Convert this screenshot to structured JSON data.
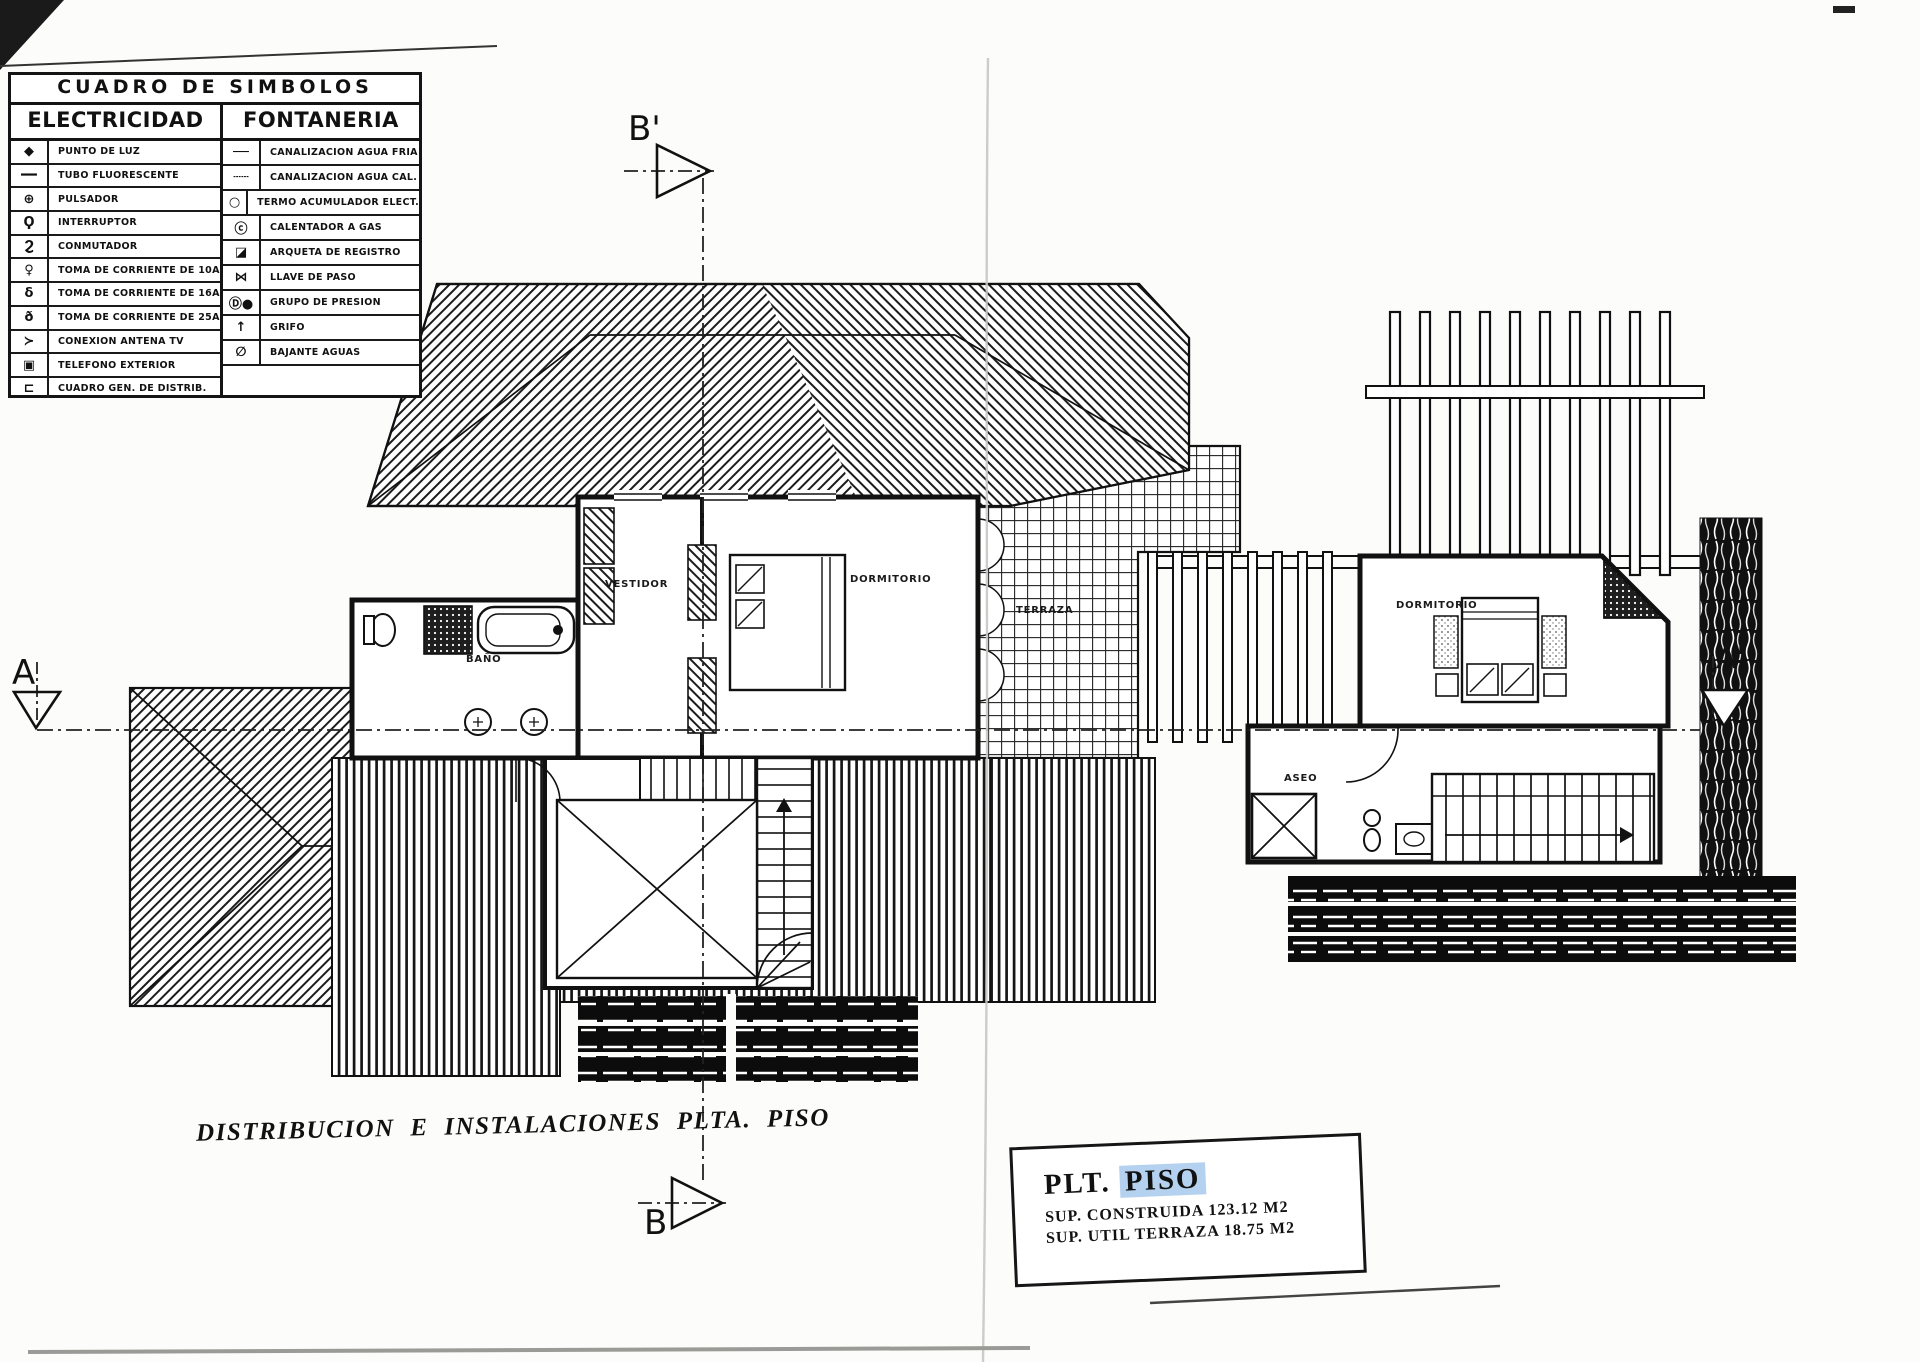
{
  "legend": {
    "title": "CUADRO DE SIMBOLOS",
    "columns": [
      {
        "title": "ELECTRICIDAD",
        "rows": [
          {
            "icon": "punto-de-luz",
            "glyph": "◆",
            "label": "PUNTO DE LUZ"
          },
          {
            "icon": "tubo-fluorescente",
            "glyph": "━━",
            "label": "TUBO FLUORESCENTE"
          },
          {
            "icon": "pulsador",
            "glyph": "⊕",
            "label": "PULSADOR"
          },
          {
            "icon": "interruptor",
            "glyph": "Ϙ",
            "label": "INTERRUPTOR"
          },
          {
            "icon": "conmutador",
            "glyph": "Ϩ",
            "label": "CONMUTADOR"
          },
          {
            "icon": "toma-corriente-10a",
            "glyph": "♀",
            "label": "TOMA DE CORRIENTE DE 10A"
          },
          {
            "icon": "toma-corriente-16a",
            "glyph": "δ",
            "label": "TOMA DE CORRIENTE DE 16A"
          },
          {
            "icon": "toma-corriente-25a",
            "glyph": "ð",
            "label": "TOMA DE CORRIENTE DE 25A"
          },
          {
            "icon": "conexion-antena-tv",
            "glyph": "≻",
            "label": "CONEXION ANTENA TV"
          },
          {
            "icon": "telefono-exterior",
            "glyph": "▣",
            "label": "TELEFONO EXTERIOR"
          },
          {
            "icon": "cuadro-general-distribucion",
            "glyph": "⊏",
            "label": "CUADRO GEN. DE DISTRIB."
          }
        ]
      },
      {
        "title": "FONTANERIA",
        "rows": [
          {
            "icon": "canalizacion-agua-fria",
            "glyph": "──",
            "label": "CANALIZACION AGUA FRIA"
          },
          {
            "icon": "canalizacion-agua-caliente",
            "glyph": "┄┄",
            "label": "CANALIZACION AGUA CAL."
          },
          {
            "icon": "termo-acumulador-electrico",
            "glyph": "○",
            "label": "TERMO ACUMULADOR ELECT."
          },
          {
            "icon": "calentador-a-gas",
            "glyph": "ⓒ",
            "label": "CALENTADOR A GAS"
          },
          {
            "icon": "arqueta-de-registro",
            "glyph": "◪",
            "label": "ARQUETA DE REGISTRO"
          },
          {
            "icon": "llave-de-paso",
            "glyph": "⋈",
            "label": "LLAVE DE PASO"
          },
          {
            "icon": "grupo-de-presion",
            "glyph": "Ⓓ●",
            "label": "GRUPO DE PRESION"
          },
          {
            "icon": "grifo",
            "glyph": "↑",
            "label": "GRIFO"
          },
          {
            "icon": "bajante-aguas",
            "glyph": "∅",
            "label": "BAJANTE AGUAS"
          }
        ]
      }
    ]
  },
  "plan": {
    "rooms": {
      "vestidor": "VESTIDOR",
      "dormitorio": "DORMITORIO",
      "bano": "BAÑO",
      "terraza": "TERRAZA",
      "dormitorio_2": "DORMITORIO",
      "aseo": "ASEO"
    },
    "section_markers": {
      "a": "A",
      "a_prime": "A'",
      "b": "B",
      "b_prime": "B'"
    }
  },
  "caption": "DISTRIBUCION E INSTALACIONES PLTA. PISO",
  "title_block": {
    "line1_label": "PLT.",
    "line1_value": "PISO",
    "line2": "SUP. CONSTRUIDA 123.12 M2",
    "line3": "SUP. UTIL TERRAZA 18.75 M2"
  },
  "colors": {
    "ink": "#111111",
    "paper": "#fcfcfa",
    "selection_highlight": "#b4d2ef"
  }
}
